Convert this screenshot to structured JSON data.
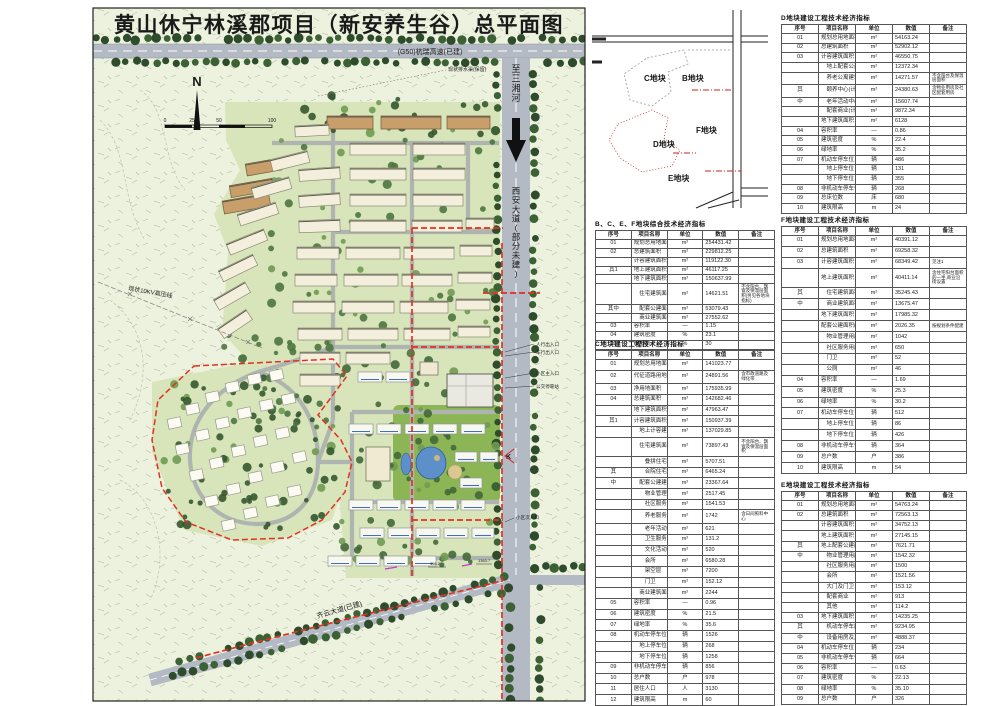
{
  "title": "黄山休宁林溪郡项目（新安养生谷）总平面图",
  "plan": {
    "labels": {
      "highway": "(G50)杭瑞高速(已建)",
      "river": "至三湘河",
      "xian_avenue": "西安大道(部分未建)",
      "power_line": "现状10KV高压线",
      "bottom_road": "齐云大道(已建)",
      "drain_note": "现状排水渠(保留)",
      "north": "N",
      "entry_mark": "K",
      "station_1": "356.2",
      "station_2": "1363.7",
      "scale_ticks": [
        "0",
        "25",
        "50",
        "100"
      ],
      "annotations": [
        "人行出入口",
        "车行出入口",
        "小区主入口",
        "公交停靠站",
        "小区次入口"
      ]
    }
  },
  "keyplan": {
    "plots": {
      "c": "C地块",
      "b": "B地块",
      "f": "F地块",
      "d": "D地块",
      "e": "E地块"
    }
  },
  "tables": {
    "d": {
      "title": "D地块建设工程技术经济指标",
      "headers": [
        "序号",
        "项目名称",
        "单位",
        "数值",
        "备注"
      ],
      "rows": [
        [
          "01",
          "规划总用地面积",
          "m²",
          "54163.24",
          ""
        ],
        [
          "02",
          "总建筑面积",
          "m²",
          "52902.12",
          ""
        ],
        [
          "03",
          "计容建筑面积",
          "m²",
          "46550.75",
          ""
        ],
        [
          "",
          "　地上配套公建面积",
          "m²",
          "12372.34",
          ""
        ],
        [
          "",
          "　养老公寓建筑面积",
          "m²",
          "14271.57",
          "不含阳台及保温层面积"
        ],
        [
          "其",
          "　颐养中心(计容)",
          "m²",
          "24380.63",
          "含物业用房及社区配套用房"
        ],
        [
          "中",
          "　老年活动中心(计容)",
          "m²",
          "15607.74",
          ""
        ],
        [
          "",
          "　配套商业(计容)",
          "m²",
          "9872.34",
          ""
        ],
        [
          "",
          "地下建筑面积",
          "m²",
          "6128",
          ""
        ],
        [
          "04",
          "容积率",
          "—",
          "0.86",
          ""
        ],
        [
          "05",
          "建筑密度",
          "%",
          "22.4",
          ""
        ],
        [
          "06",
          "绿地率",
          "%",
          "35.2",
          ""
        ],
        [
          "07",
          "机动车停车位",
          "辆",
          "486",
          ""
        ],
        [
          "",
          "　地上停车位",
          "辆",
          "131",
          ""
        ],
        [
          "",
          "　地下停车位",
          "辆",
          "355",
          ""
        ],
        [
          "08",
          "非机动车停车位",
          "辆",
          "268",
          ""
        ],
        [
          "09",
          "总床位数",
          "床",
          "680",
          ""
        ],
        [
          "10",
          "建筑限高",
          "m",
          "24",
          ""
        ]
      ]
    },
    "comp": {
      "title": "B、C、E、F地块综合技术经济指标",
      "headers": [
        "序号",
        "项目名称",
        "单位",
        "数值",
        "备注"
      ],
      "rows": [
        [
          "01",
          "规划总用地面积",
          "m²",
          "254431.42",
          ""
        ],
        [
          "02",
          "总建筑面积",
          "m²",
          "229812.25",
          ""
        ],
        [
          "",
          "计容建筑面积",
          "m²",
          "119122.30",
          ""
        ],
        [
          "其1",
          "地上建筑面积",
          "m²",
          "46117.25",
          ""
        ],
        [
          "",
          "地下建筑面积(不计容)",
          "m²",
          "150637.99",
          ""
        ],
        [
          "",
          "　住宅建筑面积",
          "m²",
          "14621.51",
          "不含阳台、飘窗及保温层面积(另见各地块指标)"
        ],
        [
          "其中",
          "　配套公建面积",
          "m²",
          "53079.43",
          ""
        ],
        [
          "",
          "　商业建筑面积",
          "m²",
          "27552.62",
          ""
        ],
        [
          "03",
          "容积率",
          "—",
          "1.15",
          ""
        ],
        [
          "04",
          "建筑密度",
          "%",
          "23.1",
          ""
        ],
        [
          "05",
          "绿地率",
          "%",
          "30",
          ""
        ]
      ]
    },
    "c": {
      "title": "C地块建设工程技术经济指标",
      "headers": [
        "序号",
        "项目名称",
        "单位",
        "数值",
        "备注"
      ],
      "rows": [
        [
          "01",
          "规划总用地面积",
          "m²",
          "141023.77",
          ""
        ],
        [
          "02",
          "代征道路用地面积",
          "m²",
          "24891.56",
          "含市政道路及绿化带"
        ],
        [
          "03",
          "净用地面积",
          "m²",
          "175935.99",
          ""
        ],
        [
          "04",
          "总建筑面积",
          "m²",
          "142682.46",
          ""
        ],
        [
          "",
          "地下建筑面积",
          "m²",
          "47963.47",
          ""
        ],
        [
          "其1",
          "计容建筑面积(小计)",
          "m²",
          "150937.39",
          ""
        ],
        [
          "",
          "　地上计容建筑面积",
          "m²",
          "137029.85",
          ""
        ],
        [
          "",
          "　住宅建筑面积",
          "m²",
          "73897.43",
          "不含阳台、飘窗及保温层面积"
        ],
        [
          "",
          "　　叠拼住宅",
          "m²",
          "5707.51",
          ""
        ],
        [
          "其",
          "　　合院住宅",
          "m²",
          "6465.24",
          ""
        ],
        [
          "中",
          "　配套公建建筑面积",
          "m²",
          "23367.64",
          ""
        ],
        [
          "",
          "　　物业管理用房",
          "m²",
          "2517.45",
          ""
        ],
        [
          "",
          "　　社区服务用房",
          "m²",
          "1541.53",
          ""
        ],
        [
          "",
          "　　养老服务中心",
          "m²",
          "1742",
          "含日间照料中心"
        ],
        [
          "",
          "　　老年活动用房",
          "m²",
          "621",
          ""
        ],
        [
          "",
          "　　卫生服务站",
          "m²",
          "131.2",
          ""
        ],
        [
          "",
          "　　文化活动站",
          "m²",
          "520",
          ""
        ],
        [
          "",
          "　　会所",
          "m²",
          "6580.28",
          ""
        ],
        [
          "",
          "　　架空层",
          "m²",
          "7200",
          ""
        ],
        [
          "",
          "　　门卫",
          "m²",
          "152.12",
          ""
        ],
        [
          "",
          "　商业建筑面积",
          "m²",
          "2244",
          ""
        ],
        [
          "05",
          "容积率",
          "—",
          "0.96",
          ""
        ],
        [
          "06",
          "建筑密度",
          "%",
          "21.5",
          ""
        ],
        [
          "07",
          "绿地率",
          "%",
          "35.6",
          ""
        ],
        [
          "08",
          "机动车停车位",
          "辆",
          "1526",
          ""
        ],
        [
          "",
          "　地上停车位",
          "辆",
          "268",
          ""
        ],
        [
          "",
          "　地下停车位",
          "辆",
          "1258",
          ""
        ],
        [
          "09",
          "非机动车停车位",
          "辆",
          "856",
          ""
        ],
        [
          "10",
          "总户数",
          "户",
          "978",
          ""
        ],
        [
          "11",
          "居住人口",
          "人",
          "3130",
          ""
        ],
        [
          "12",
          "建筑限高",
          "m",
          "60",
          ""
        ]
      ]
    },
    "f": {
      "title": "F地块建设工程技术经济指标",
      "headers": [
        "序号",
        "项目名称",
        "单位",
        "数值",
        "备注"
      ],
      "rows": [
        [
          "01",
          "规划总用地面积",
          "m²",
          "40391.12",
          ""
        ],
        [
          "02",
          "总建筑面积",
          "m²",
          "69258.32",
          ""
        ],
        [
          "03",
          "计容建筑面积",
          "m²",
          "68349.42",
          "见注1"
        ],
        [
          "",
          "地上建筑面积",
          "m²",
          "40411.14",
          "含住宅阳台面积的一半,商业沿街设置"
        ],
        [
          "其",
          "　住宅建筑面积",
          "m²",
          "35245.43",
          ""
        ],
        [
          "中",
          "　商业建筑面积",
          "m²",
          "13675.47",
          ""
        ],
        [
          "",
          "地下建筑面积",
          "m²",
          "17985.32",
          ""
        ],
        [
          "",
          "配套公建面积(小计)",
          "m²",
          "2026.35",
          "按规划条件配建"
        ],
        [
          "",
          "　物业管理用房",
          "m²",
          "1042",
          ""
        ],
        [
          "",
          "　社区服务用房",
          "m²",
          "650",
          ""
        ],
        [
          "",
          "　门卫",
          "m²",
          "52",
          ""
        ],
        [
          "",
          "　公厕",
          "m²",
          "46",
          ""
        ],
        [
          "04",
          "容积率",
          "—",
          "1.69",
          ""
        ],
        [
          "05",
          "建筑密度",
          "%",
          "25.3",
          ""
        ],
        [
          "06",
          "绿地率",
          "%",
          "30.2",
          ""
        ],
        [
          "07",
          "机动车停车位",
          "辆",
          "512",
          ""
        ],
        [
          "",
          "　地上停车位",
          "辆",
          "86",
          ""
        ],
        [
          "",
          "　地下停车位",
          "辆",
          "426",
          ""
        ],
        [
          "08",
          "非机动车停车位",
          "辆",
          "364",
          ""
        ],
        [
          "09",
          "总户数",
          "户",
          "386",
          ""
        ],
        [
          "10",
          "建筑限高",
          "m",
          "54",
          ""
        ]
      ]
    },
    "e": {
      "title": "E地块建设工程技术经济指标",
      "headers": [
        "序号",
        "项目名称",
        "单位",
        "数值",
        "备注"
      ],
      "rows": [
        [
          "01",
          "规划总用地面积",
          "m²",
          "54763.24",
          ""
        ],
        [
          "02",
          "总建筑面积",
          "m²",
          "72563.13",
          ""
        ],
        [
          "",
          "计容建筑面积",
          "m²",
          "34752.13",
          ""
        ],
        [
          "",
          "地上建筑面积",
          "m²",
          "27145.15",
          ""
        ],
        [
          "其",
          "地上配套公建面积",
          "m²",
          "7621.71",
          ""
        ],
        [
          "中",
          "　物业管理用房",
          "m²",
          "1542.32",
          ""
        ],
        [
          "",
          "　社区服务用房",
          "m²",
          "1500",
          ""
        ],
        [
          "",
          "　会所",
          "m²",
          "1521.56",
          ""
        ],
        [
          "",
          "　大门及门卫",
          "m²",
          "153.12",
          ""
        ],
        [
          "",
          "　配套商业",
          "m²",
          "913",
          ""
        ],
        [
          "",
          "　其他",
          "m²",
          "114.2",
          ""
        ],
        [
          "03",
          "地下建筑面积",
          "m²",
          "14235.25",
          ""
        ],
        [
          "其",
          "　机动车停车库",
          "m²",
          "9234.95",
          ""
        ],
        [
          "中",
          "　设备用房及其他",
          "m²",
          "4888.37",
          ""
        ],
        [
          "04",
          "机动车停车位",
          "辆",
          "234",
          ""
        ],
        [
          "05",
          "非机动车停车位",
          "辆",
          "664",
          ""
        ],
        [
          "06",
          "容积率",
          "—",
          "0.63",
          ""
        ],
        [
          "07",
          "建筑密度",
          "%",
          "22.13",
          ""
        ],
        [
          "08",
          "绿地率",
          "%",
          "35.10",
          ""
        ],
        [
          "09",
          "总户数",
          "户",
          "326",
          ""
        ]
      ]
    }
  }
}
